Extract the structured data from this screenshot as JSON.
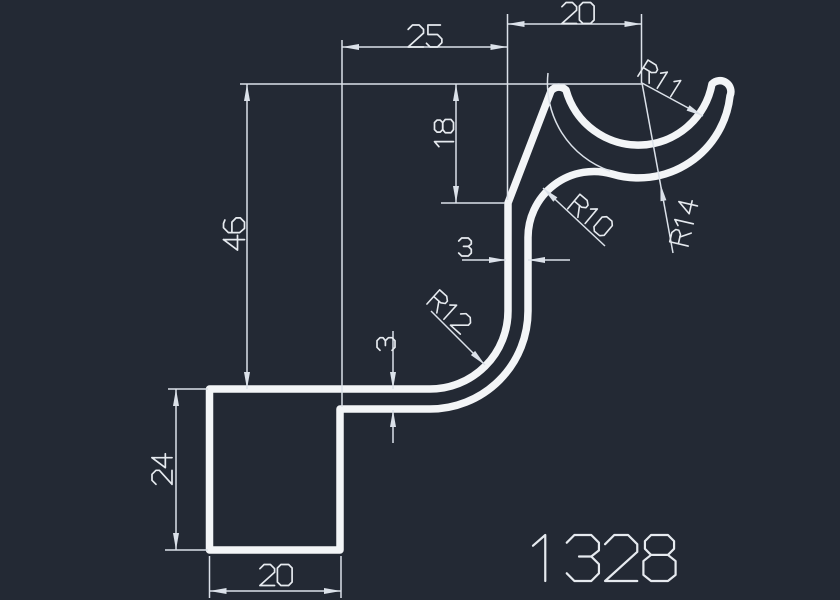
{
  "colors": {
    "background": "#232934",
    "profile_line": "#f3f5f7",
    "dimension_line": "#dbe1e9",
    "dimension_text": "#e6eaef"
  },
  "drawing": {
    "part_number": "1328",
    "dimensions": {
      "top_width": "20",
      "hook_offset": "25",
      "overall_height": "46",
      "hook_depth": "18",
      "thickness_upper": "3",
      "thickness_lower": "3",
      "base_height": "24",
      "base_width": "20"
    },
    "radii": {
      "cup_inner": "R11",
      "neck": "R10",
      "cup_outer": "R14",
      "lower_bend": "R12"
    }
  }
}
